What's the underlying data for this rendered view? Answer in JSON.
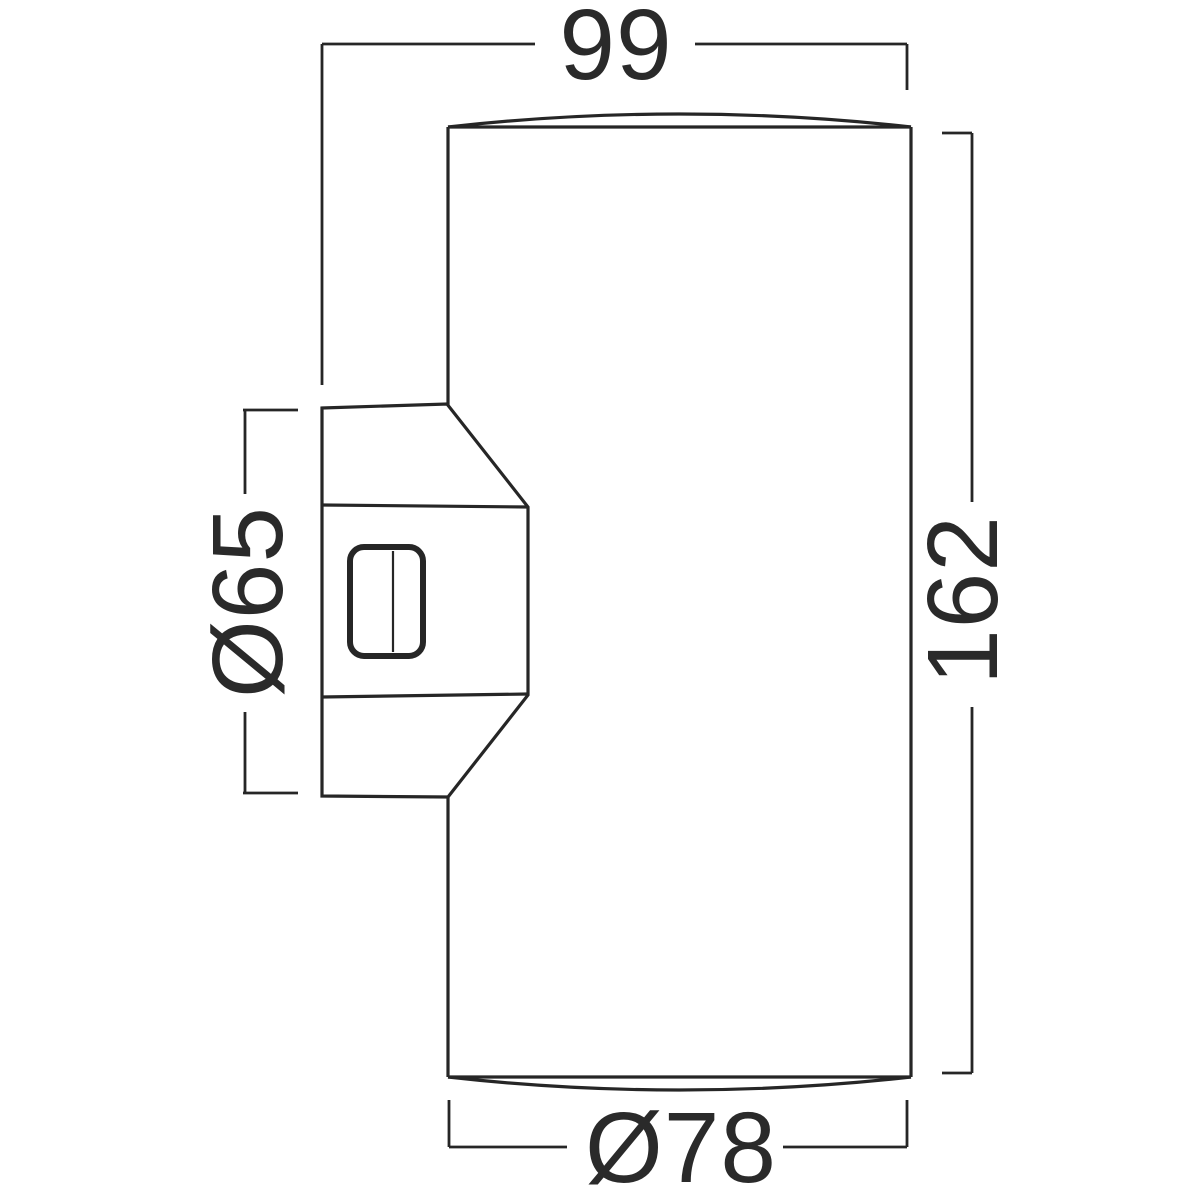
{
  "drawing": {
    "line_color": "#262626",
    "text_color": "#2a2a2a",
    "background": "#ffffff"
  },
  "dimensions": {
    "width_top": {
      "label": "99",
      "value": 99
    },
    "height_right": {
      "label": "162",
      "value": 162
    },
    "bracket_left": {
      "label": "Ø65",
      "value": 65
    },
    "diameter_bottom": {
      "label": "Ø78",
      "value": 78
    }
  }
}
